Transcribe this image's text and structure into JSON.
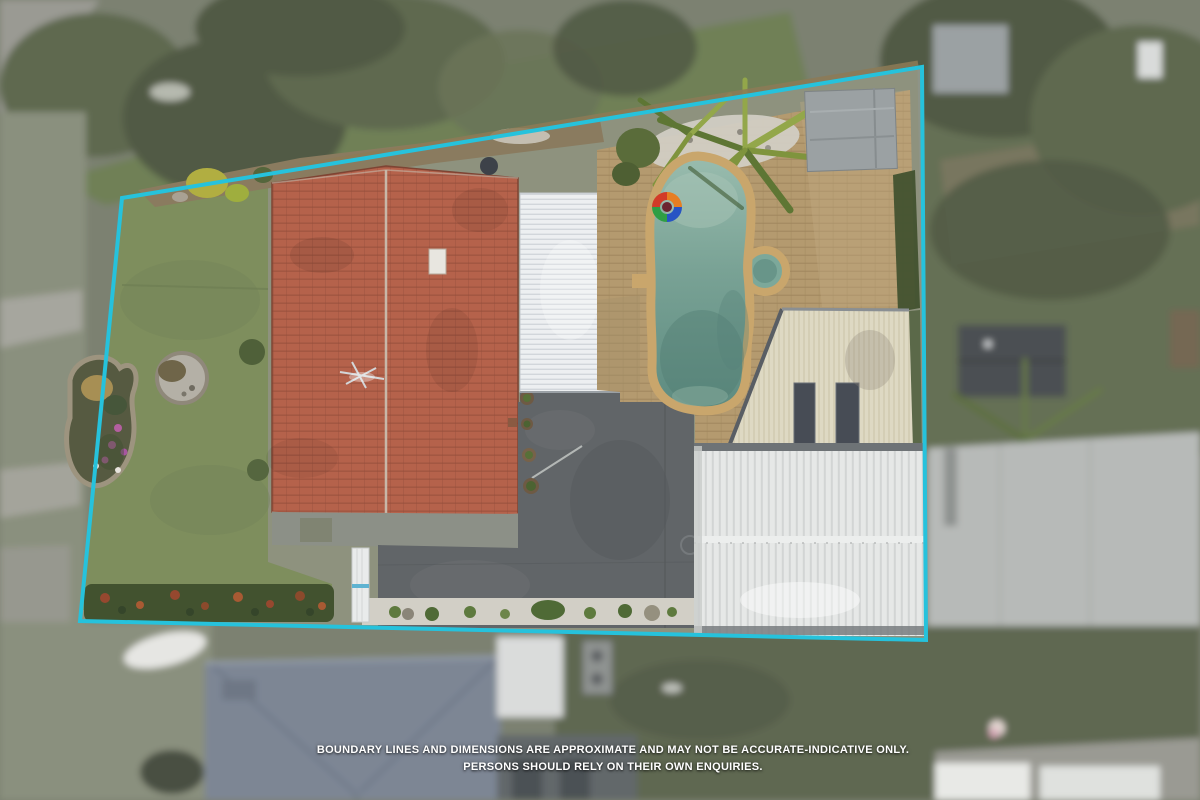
{
  "photo": {
    "type": "aerial-property-photograph",
    "subject": "residential property with pool, red tile roof house, pergola, garage and lawn"
  },
  "disclaimer": {
    "line1": "BOUNDARY LINES AND DIMENSIONS ARE APPROXIMATE AND MAY NOT BE ACCURATE-INDICATIVE ONLY.",
    "line2": "PERSONS SHOULD RELY ON THEIR OWN ENQUIRIES."
  },
  "boundary": {
    "color": "#26c2dc",
    "stroke_width": 4,
    "points": [
      [
        122,
        198
      ],
      [
        922,
        67
      ],
      [
        926,
        640
      ],
      [
        80,
        621
      ]
    ]
  },
  "palette": {
    "boundary": "#26c2dc",
    "white": "#ffffff",
    "fence": "#8d7b56",
    "lawn": "#7e8e5d",
    "lawnTop": "#6f8057",
    "lawnEast": "#656f55",
    "lawnSouth": "#5e6751",
    "lawnSW": "#8a907e",
    "soil": "#8a7b5f",
    "roofTile": "#b5624b",
    "tileLine": "#934e3b",
    "ridge": "#cbc1b3",
    "pergola": "#edeff1",
    "pergolaRib": "#d2d6db",
    "paving": "#b49a6f",
    "pavingLine": "#9e855c",
    "coping": "#c9a66c",
    "waterTop": "#99bcae",
    "waterMid": "#79a295",
    "waterDeep": "#5d8b80",
    "cream": "#ded9c3",
    "creamRib": "#cdc6ac",
    "skylightDark": "#474c55",
    "garage": "#e6e8e7",
    "garageRib": "#d2d5d4",
    "garageEdge": "#6e7376",
    "concrete": "#616568",
    "concreteLight": "#8c9087",
    "hedge": "#42522f",
    "hedgeBerry": "#96482f",
    "pebble": "#d2cfc6",
    "treeDark": "#515a45",
    "treeMid": "#5f6950",
    "treeLight": "#6b7458",
    "street": "#9a9a93",
    "path": "#a6a69e",
    "neighborRoofSouth": "#7d8694",
    "shed": "#9ba1a3",
    "shedEast": "#4b4f52",
    "bigBuildingEast": "#b7bab8",
    "whiteRoof": "#dadcdb",
    "palm": "#7f943d",
    "palmDark": "#5e7634",
    "palmLight": "#93a74a",
    "yellowBush": "#b1ae41",
    "floatRed": "#d23b28",
    "floatOrange": "#e67e22",
    "floatBlue": "#2753c4",
    "floatGreen": "#2f9e44",
    "gateBlue": "#5fb3d1"
  }
}
